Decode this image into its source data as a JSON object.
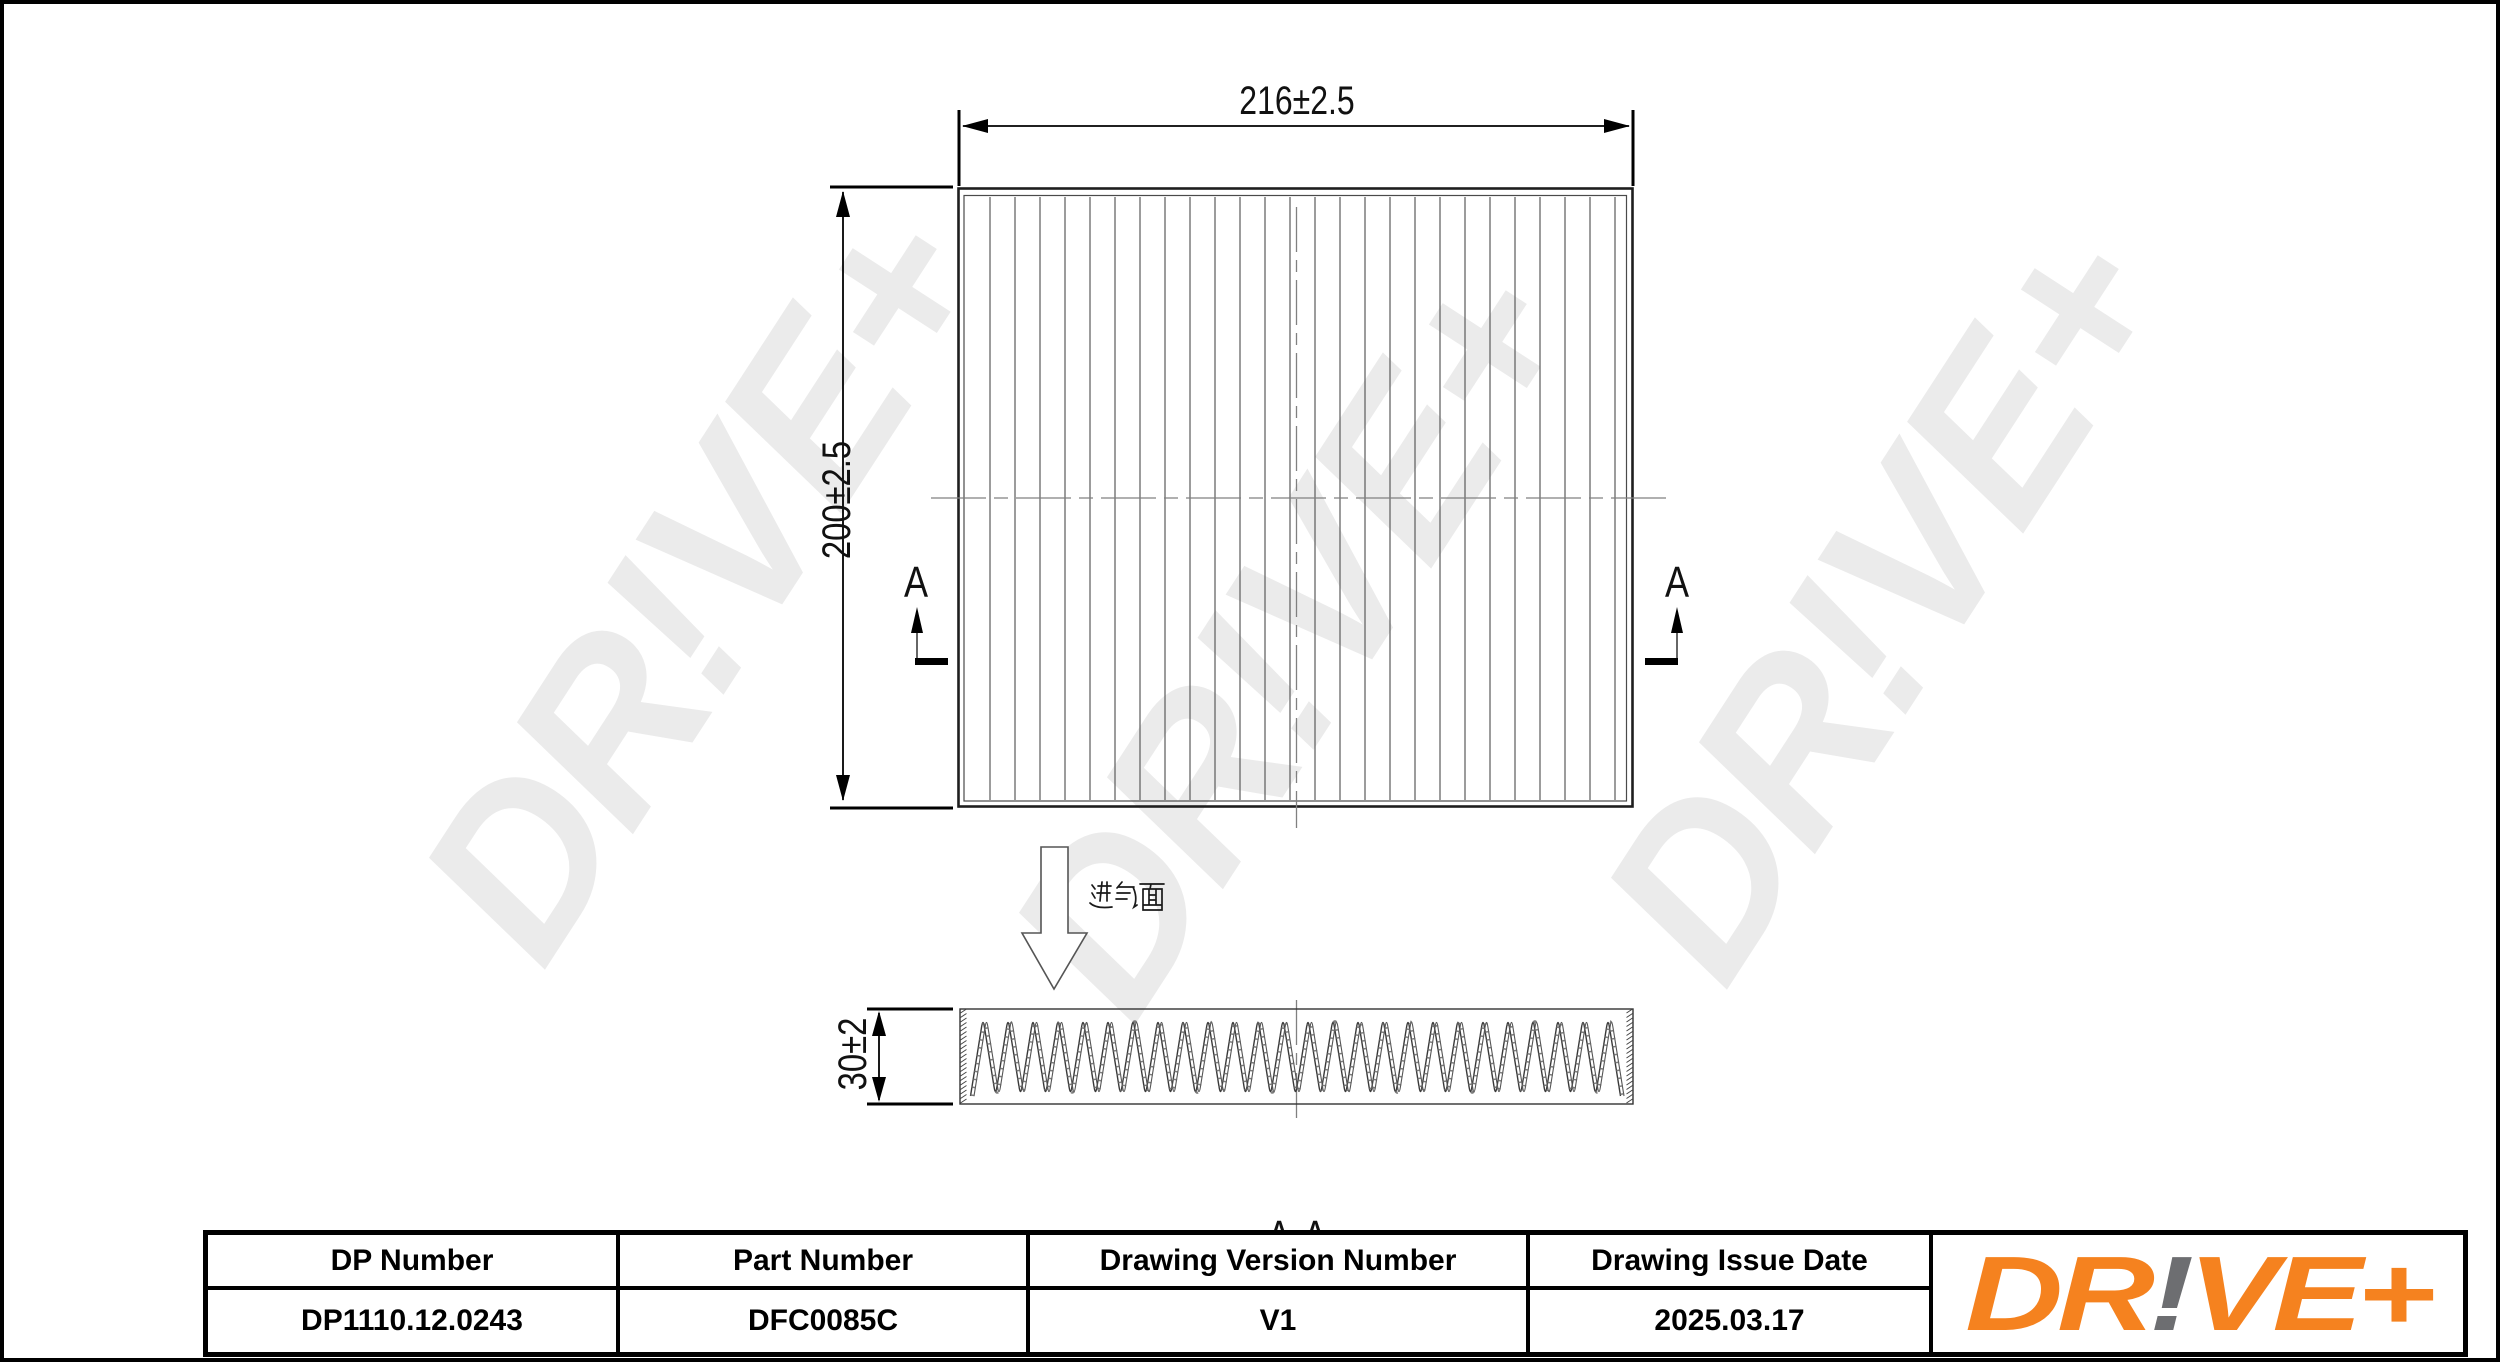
{
  "drawing": {
    "dim_width": "216±2.5",
    "dim_height": "200±2.5",
    "dim_depth": "30±2",
    "section_marker": "A",
    "section_label": "A-A",
    "intake_label": "进气面",
    "watermark_text": "DR!VE+"
  },
  "table": {
    "columns": [
      {
        "header": "DP Number",
        "value": "DP1110.12.0243"
      },
      {
        "header": "Part Number",
        "value": "DFC0085C"
      },
      {
        "header": "Drawing Version Number",
        "value": "V1"
      },
      {
        "header": "Drawing Issue Date",
        "value": "2025.03.17"
      }
    ]
  },
  "logo": {
    "part_dr": "DR",
    "part_excl": "!",
    "part_ve": "VE+"
  },
  "colors": {
    "logo_orange": "#F5821F",
    "logo_gray": "#6D6E71",
    "watermark": "#EBEBEB"
  }
}
